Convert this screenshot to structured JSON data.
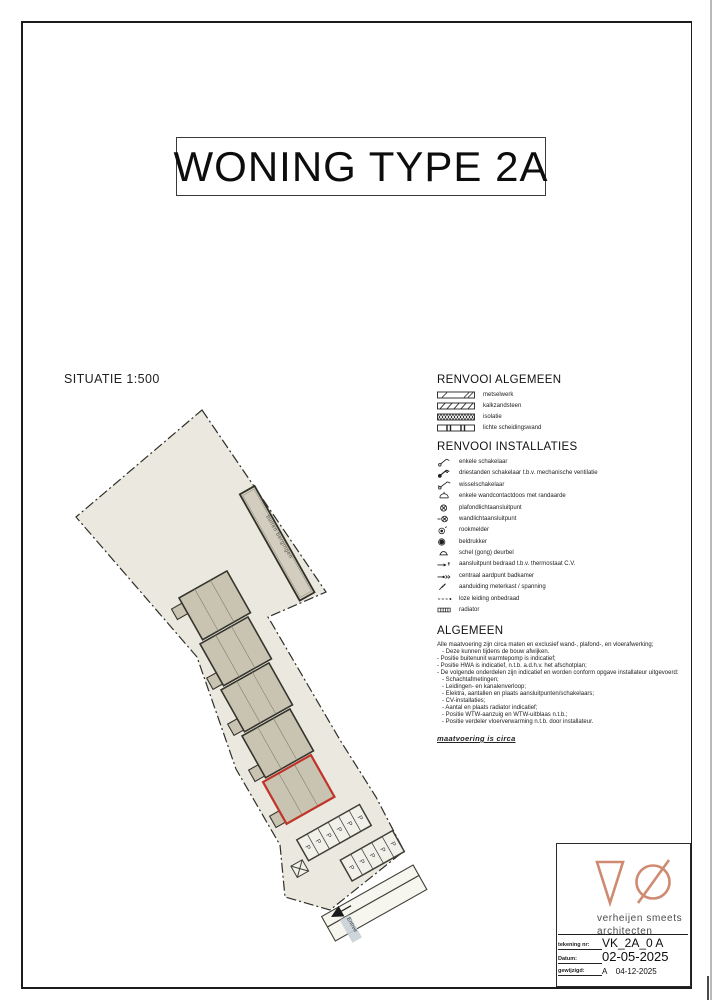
{
  "page": {
    "title": "WONING TYPE 2A"
  },
  "site_plan": {
    "label": "SITUATIE 1:500",
    "berging_label": "buiten bergingen",
    "entree_label": "Entree",
    "parking_letter": "P"
  },
  "colors": {
    "highlight_red": "#c0342a",
    "logo_coral": "#cf8a72"
  },
  "legend_general": {
    "title": "RENVOOI ALGEMEEN",
    "items": [
      {
        "icon": "hatch-metselwerk",
        "label": "metselwerk"
      },
      {
        "icon": "hatch-kalkzandsteen",
        "label": "kalkzandsteen"
      },
      {
        "icon": "hatch-isolatie",
        "label": "isolatie"
      },
      {
        "icon": "hatch-scheidingswand",
        "label": "lichte scheidingswand"
      }
    ]
  },
  "legend_installations": {
    "title": "RENVOOI INSTALLATIES",
    "items": [
      {
        "icon": "single-switch",
        "label": "enkele schakelaar"
      },
      {
        "icon": "three-position-switch",
        "label": "driestanden schakelaar t.b.v. mechanische ventilatie"
      },
      {
        "icon": "two-way-switch",
        "label": "wisselschakelaar"
      },
      {
        "icon": "wall-socket-earthed",
        "label": "enkele wandcontactdoos met randaarde"
      },
      {
        "icon": "ceiling-light-point",
        "label": "plafondlichtaansluitpunt"
      },
      {
        "icon": "wall-light-point",
        "label": "wandlichtaansluitpunt"
      },
      {
        "icon": "smoke-detector",
        "label": "rookmelder"
      },
      {
        "icon": "bell-push",
        "label": "beldrukker"
      },
      {
        "icon": "doorbell-gong",
        "label": "schel (gong) deurbel"
      },
      {
        "icon": "thermostat-point",
        "label": "aansluitpunt bedraad t.b.v. thermostaat C.V."
      },
      {
        "icon": "earth-point",
        "label": "centraal aardpunt badkamer"
      },
      {
        "icon": "meter-cabinet",
        "label": "aanduiding meterkast / spanning"
      },
      {
        "icon": "empty-conduit",
        "label": "loze leiding onbedraad"
      },
      {
        "icon": "radiator",
        "label": "radiator"
      }
    ]
  },
  "general_notes": {
    "title": "ALGEMEEN",
    "lines": [
      "Alle maatvoering zijn circa maten en exclusief wand-, plafond-, en vloerafwerking;",
      "   - Deze kunnen tijdens de bouw afwijken.",
      "- Positie buitenunit warmtepomp is indicatief;",
      "- Positie HWA is indicatief, n.t.b. a.d.h.v. het afschotplan;",
      "- De volgende onderdelen zijn indicatief en worden conform opgave installateur uitgevoerd:",
      "   - Schachtafmetingen;",
      "   - Leidingen- en kanalenverloop;",
      "   - Elektra, aantallen en plaats aansluitpunten/schakelaars;",
      "   - CV-installaties;",
      "   - Aantal en plaats radiator indicatief;",
      "   - Positie WTW-aanzuig en WTW-uitblaas n.t.b.;",
      "   - Positie verdeler vloerverwarming n.t.b. door installateur."
    ],
    "footnote": "maatvoering is circa"
  },
  "title_block": {
    "name_line1": "verheijen smeets",
    "name_line2": "architecten",
    "rows": [
      {
        "label": "tekening nr:",
        "value": "VK_2A_0 A"
      },
      {
        "label": "Datum:",
        "value": "02-05-2025"
      },
      {
        "label": "gewijzigd:",
        "value": "A    04-12-2025"
      }
    ]
  }
}
